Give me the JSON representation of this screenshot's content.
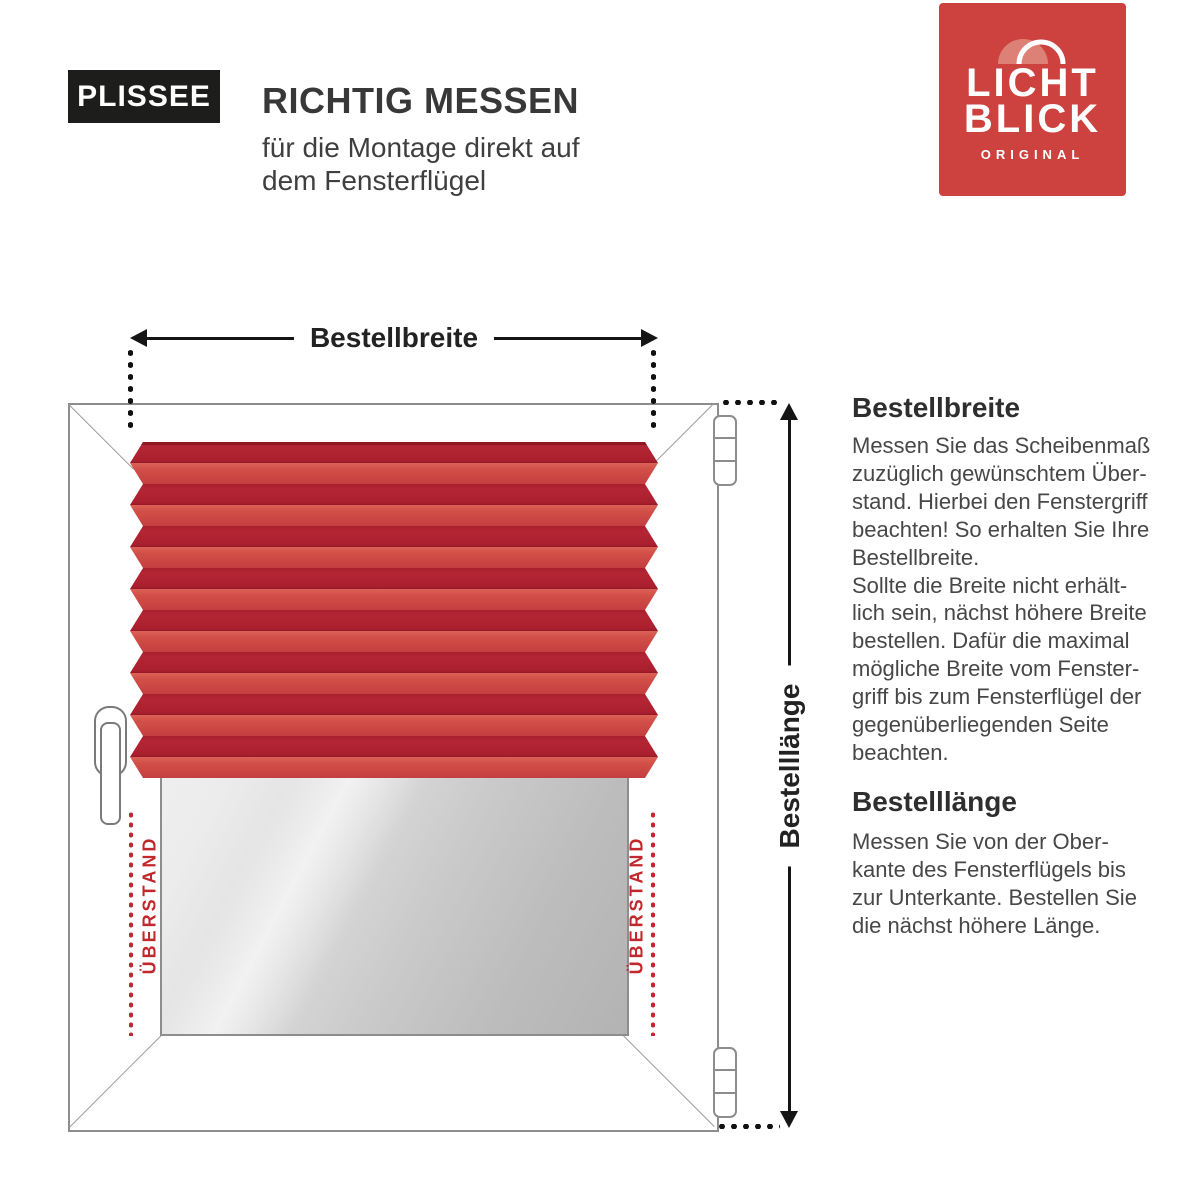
{
  "header": {
    "badge": "PLISSEE",
    "title": "RICHTIG MESSEN",
    "subtitle_lines": [
      "für die Montage direkt auf",
      "dem Fensterflügel"
    ]
  },
  "logo": {
    "line1": "LICHT",
    "line2": "BLICK",
    "subline": "ORIGINAL"
  },
  "diagram": {
    "width_label": "Bestellbreite",
    "height_label": "Bestelllänge",
    "overhang_left": "ÜBERSTAND",
    "overhang_right": "ÜBERSTAND"
  },
  "info": {
    "sections": [
      {
        "heading": "Bestellbreite",
        "lines": [
          "Messen Sie das Scheibenmaß",
          "zuzüglich gewünschtem Über-",
          "stand. Hierbei den Fenstergriff",
          "beachten! So erhalten Sie Ihre",
          "Bestellbreite.",
          "Sollte die Breite nicht erhält-",
          "lich sein, nächst höhere Breite",
          "bestellen. Dafür die maximal",
          "mögliche Breite vom Fenster-",
          "griff bis zum Fensterflügel der",
          "gegenüberliegenden Seite",
          "beachten."
        ]
      },
      {
        "heading": "Bestelllänge",
        "lines": [
          "Messen Sie von der Ober-",
          "kante des Fensterflügels bis",
          "zur Unterkante. Bestellen Sie",
          "die nächst höhere Länge."
        ]
      }
    ]
  },
  "colors": {
    "logo-red": "#cd423e",
    "blind-dark": "#aa1f2e",
    "blind-light": "#d25048",
    "overhang-red": "#c1282d"
  }
}
